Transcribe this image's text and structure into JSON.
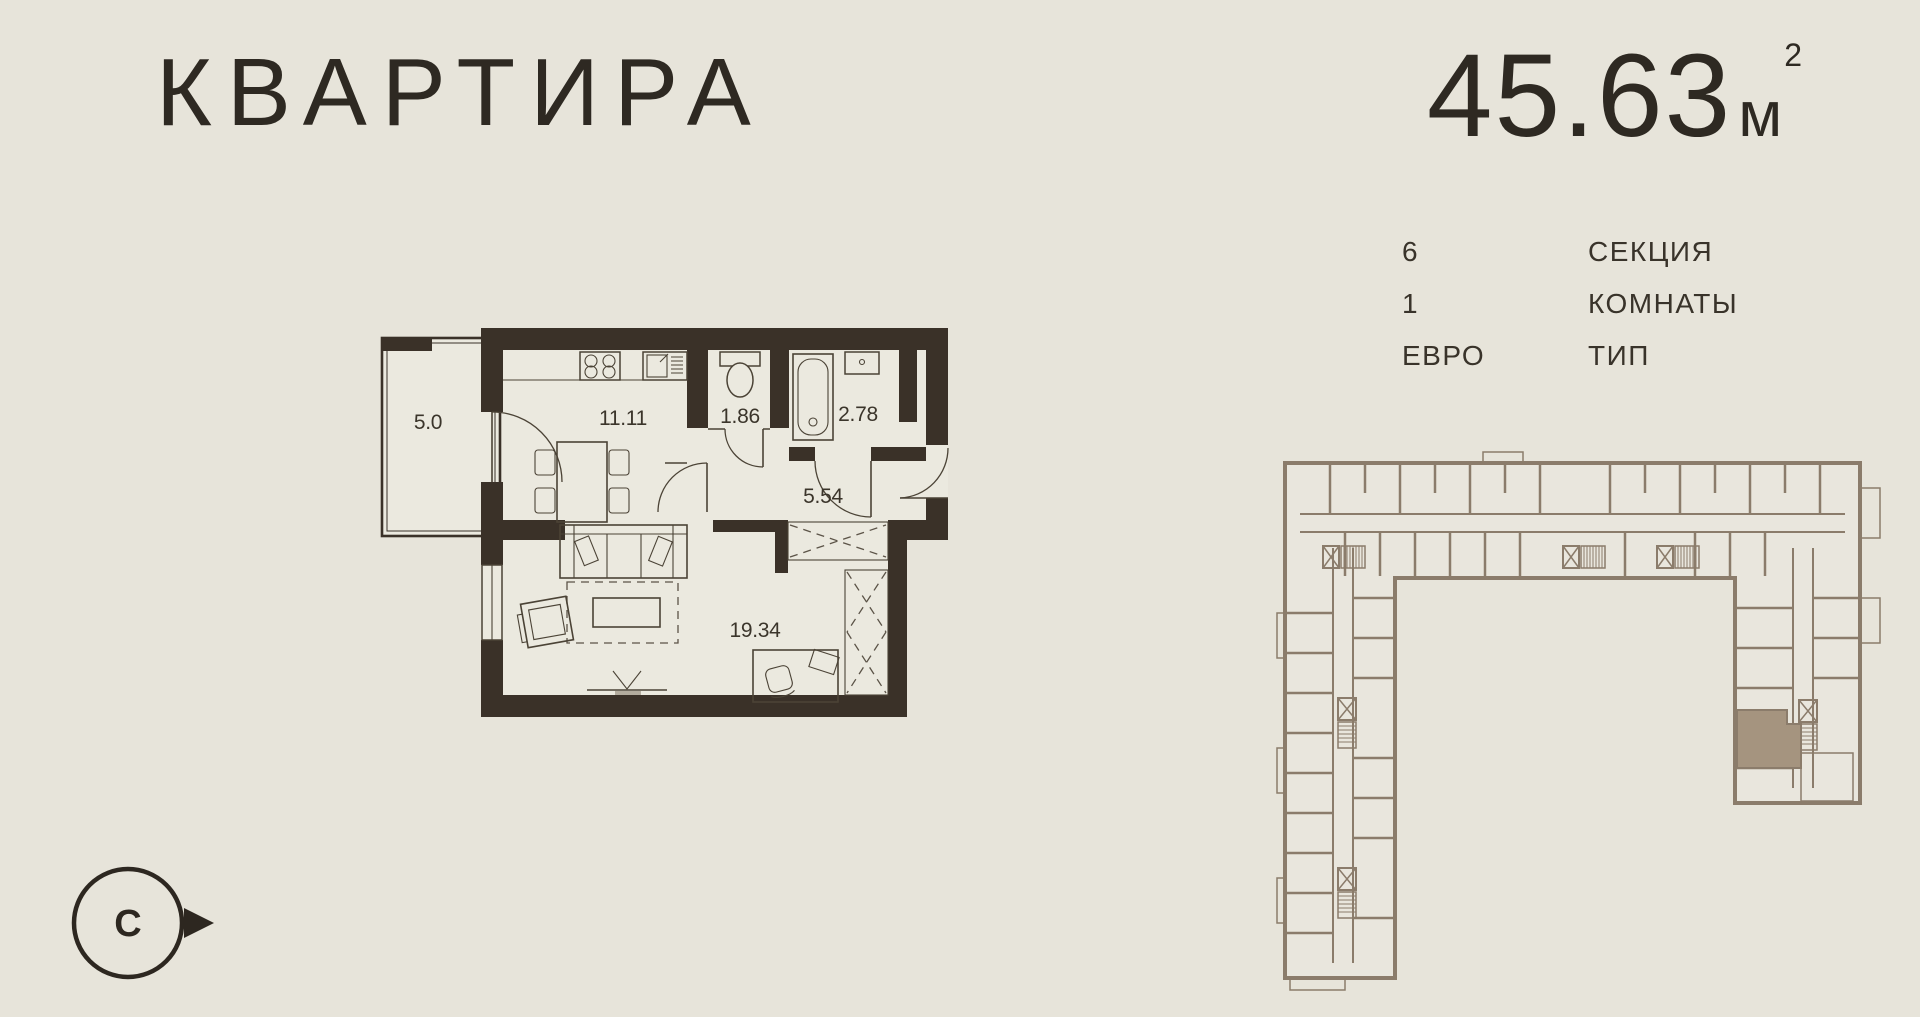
{
  "header": {
    "title": "КВАРТИРА",
    "area": {
      "value": "45.63",
      "unit": "м",
      "sup": "2"
    }
  },
  "details": {
    "rows": [
      {
        "value": "6",
        "label": "СЕКЦИЯ"
      },
      {
        "value": "1",
        "label": "КОМНАТЫ"
      },
      {
        "value": "ЕВРО",
        "label": "ТИП"
      }
    ]
  },
  "floor_plan": {
    "rooms": [
      {
        "id": "balcony",
        "area": "5.0"
      },
      {
        "id": "kitchen",
        "area": "11.11"
      },
      {
        "id": "wc",
        "area": "1.86"
      },
      {
        "id": "bathroom",
        "area": "2.78"
      },
      {
        "id": "hallway",
        "area": "5.54"
      },
      {
        "id": "living-room",
        "area": "19.34"
      }
    ]
  },
  "building_plan": {
    "shape": "U-shaped block, floor overview",
    "highlighted_unit": "selected apartment, bottom of right wing"
  },
  "compass": {
    "north_label": "С"
  },
  "colors": {
    "background": "#e7e4da",
    "apartment_walls": "#3a3128",
    "building_walls": "#8b7c6b",
    "highlight_fill": "#a5947f",
    "text": "#2e2922"
  }
}
